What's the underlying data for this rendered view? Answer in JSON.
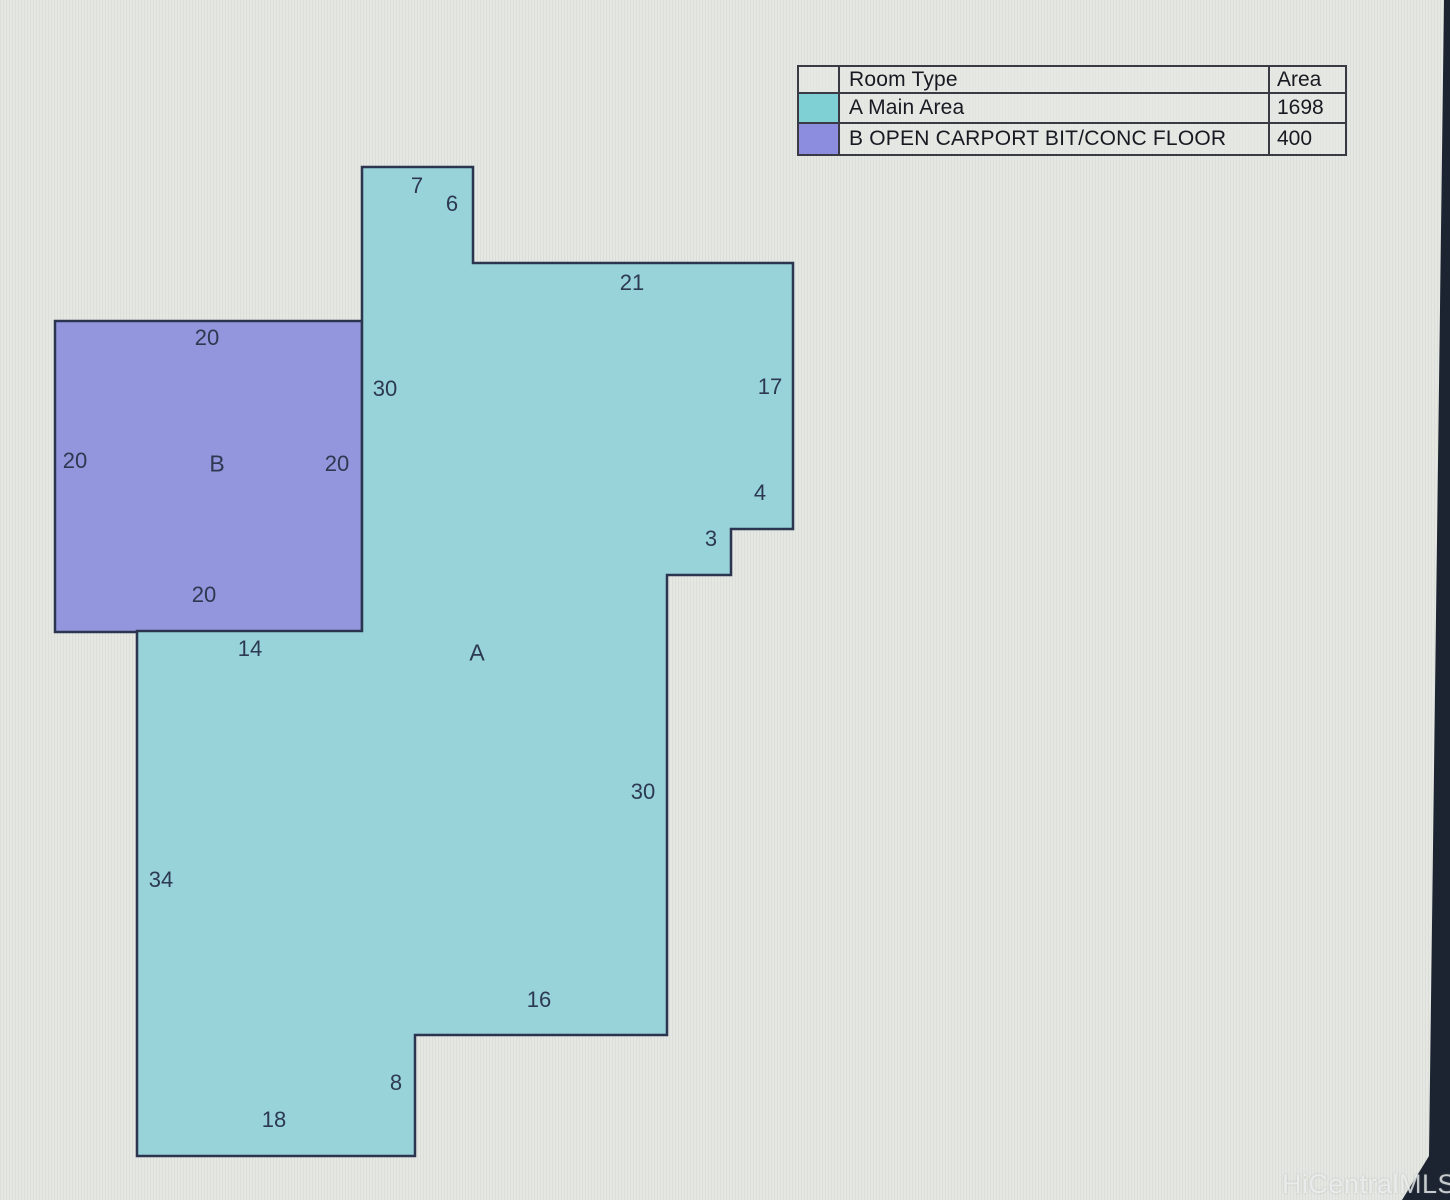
{
  "legend": {
    "header": {
      "room_type": "Room Type",
      "area": "Area"
    },
    "rows": [
      {
        "key": "A",
        "label": "A Main Area",
        "area": "1698",
        "color": "#7fd0d4"
      },
      {
        "key": "B",
        "label": "B OPEN CARPORT BIT/CONC FLOOR",
        "area": "400",
        "color": "#8d8ddf"
      }
    ]
  },
  "plan": {
    "room_a_fill": "#97d3d9",
    "room_b_fill": "#9496dd",
    "outline_color": "#2b3550",
    "labels": [
      {
        "text": "7"
      },
      {
        "text": "6"
      },
      {
        "text": "21"
      },
      {
        "text": "30"
      },
      {
        "text": "17"
      },
      {
        "text": "4"
      },
      {
        "text": "3"
      },
      {
        "text": "20"
      },
      {
        "text": "20"
      },
      {
        "text": "B"
      },
      {
        "text": "20"
      },
      {
        "text": "20"
      },
      {
        "text": "14"
      },
      {
        "text": "A"
      },
      {
        "text": "30"
      },
      {
        "text": "34"
      },
      {
        "text": "16"
      },
      {
        "text": "8"
      },
      {
        "text": "18"
      }
    ]
  },
  "screen": {
    "bezel_color": "#1c2432"
  },
  "watermark": "HiCentralMLS"
}
